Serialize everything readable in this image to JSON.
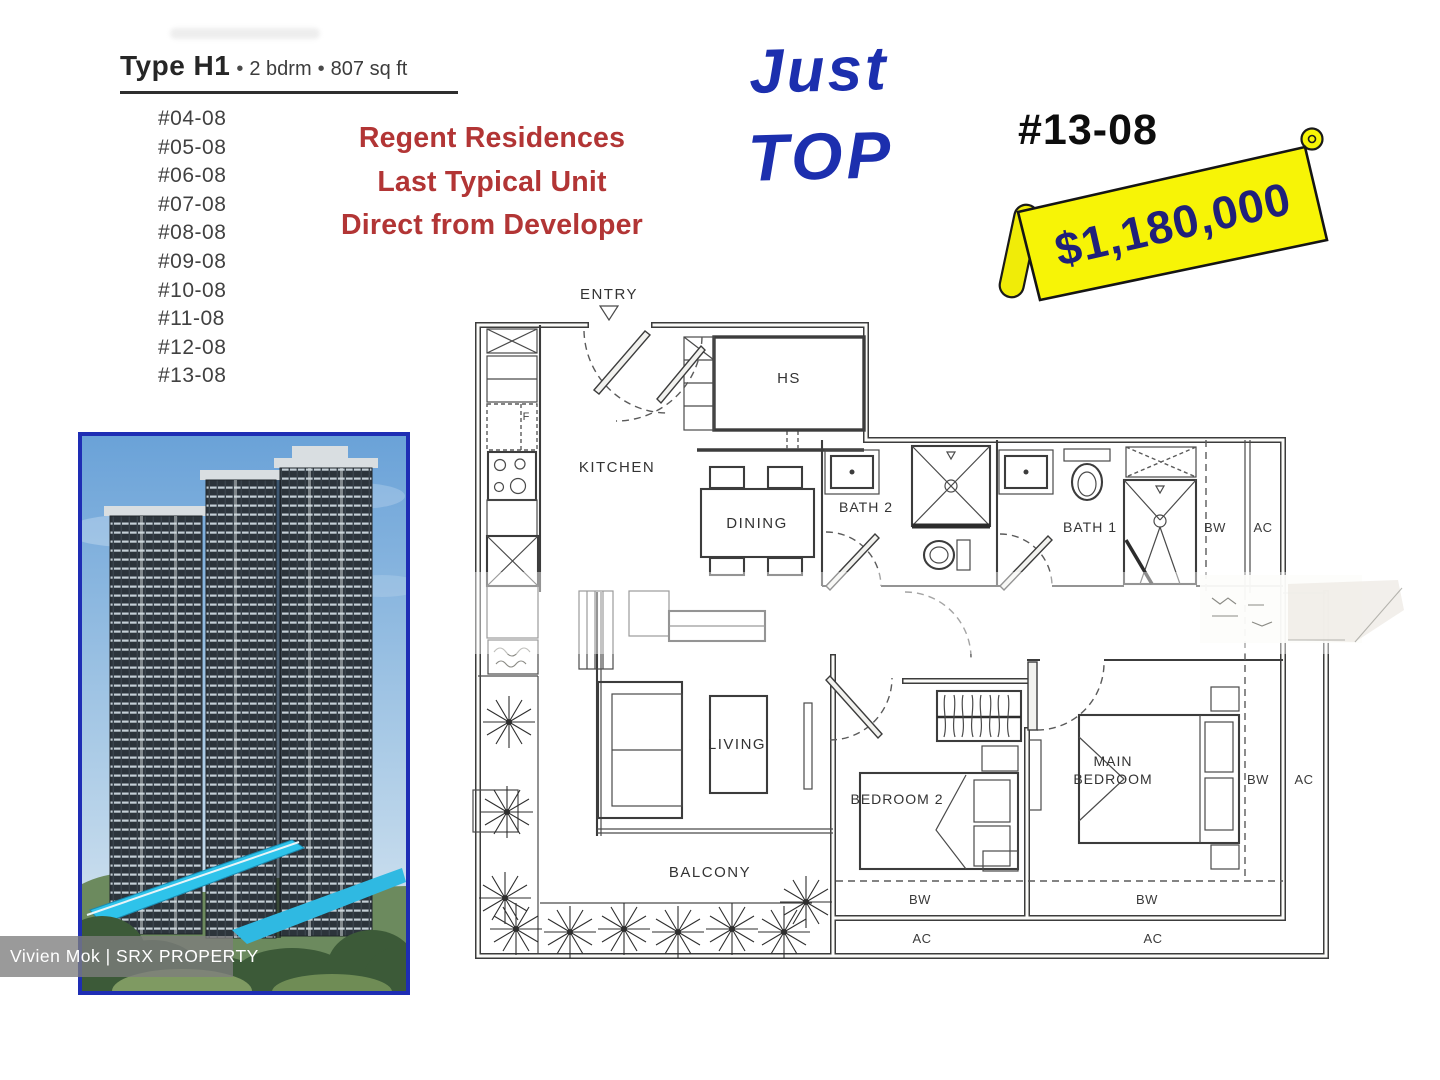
{
  "header": {
    "type_label": "Type H1",
    "sep": "•",
    "bedrooms": "2 bdrm",
    "area": "807 sq ft"
  },
  "unit_list": [
    "#04-08",
    "#05-08",
    "#06-08",
    "#07-08",
    "#08-08",
    "#09-08",
    "#10-08",
    "#11-08",
    "#12-08",
    "#13-08"
  ],
  "promo": {
    "line1": "Regent Residences",
    "line2": "Last Typical Unit",
    "line3": "Direct from Developer",
    "color": "#b23535"
  },
  "handwriting": {
    "line1": "Just",
    "line2": "TOP",
    "color": "#1c2fae"
  },
  "highlight": {
    "unit": "#13-08",
    "price": "$1,180,000",
    "banner_color": "#f7f406"
  },
  "floorplan": {
    "labels": {
      "entry": "ENTRY",
      "hs": "HS",
      "kitchen": "KITCHEN",
      "dining": "DINING",
      "bath2": "BATH 2",
      "bath1": "BATH 1",
      "living": "LIVING",
      "bedroom2": "BEDROOM 2",
      "main_line1": "MAIN",
      "main_line2": "BEDROOM",
      "balcony": "BALCONY",
      "bw": "BW",
      "ac": "AC",
      "fridge": "F"
    }
  },
  "watermark": {
    "text": "Vivien Mok | SRX PROPERTY"
  },
  "photo": {
    "border_color": "#1e2db4"
  }
}
